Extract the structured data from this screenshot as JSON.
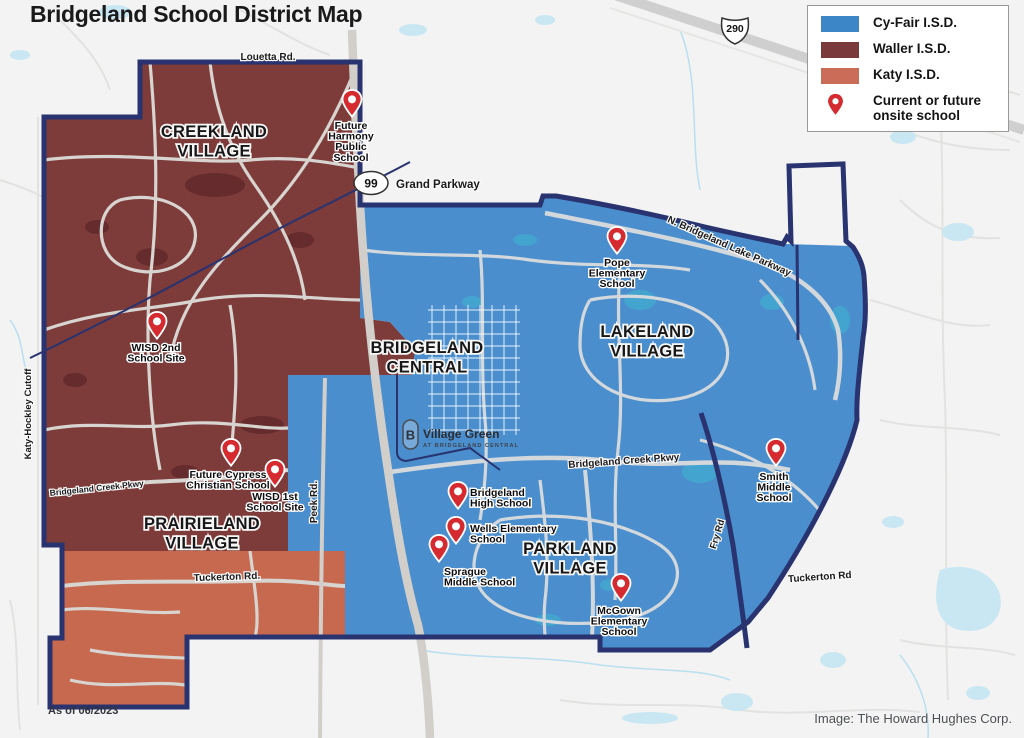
{
  "title": "Bridgeland School District Map",
  "legend": {
    "items": [
      {
        "label": "Cy-Fair I.S.D.",
        "color": "#3c86c8",
        "type": "swatch"
      },
      {
        "label": "Waller I.S.D.",
        "color": "#7a3a3b",
        "type": "swatch"
      },
      {
        "label": "Katy I.S.D.",
        "color": "#ca6c58",
        "type": "swatch"
      },
      {
        "label": "Current or future onsite school",
        "color": "#d52b30",
        "type": "pin"
      }
    ]
  },
  "footnotes": {
    "as_of": "As of 06/2023",
    "credit": "Image: The Howard Hughes Corp."
  },
  "colors": {
    "cyfair_fill": "#4a8ecd",
    "waller_fill": "#7d3b3a",
    "katy_fill": "#c7694f",
    "boundary_navy": "#28336f",
    "pin_red": "#d52b30",
    "water_outside": "#c9e7f3",
    "water_in_cyfair": "#43a4cf",
    "water_in_waller": "#662c2d"
  },
  "map": {
    "villages": [
      {
        "id": "creekland",
        "lines": [
          "CREEKLAND",
          "VILLAGE"
        ],
        "x": 214,
        "y": 137
      },
      {
        "id": "prairieland",
        "lines": [
          "PRAIRIELAND",
          "VILLAGE"
        ],
        "x": 202,
        "y": 529
      },
      {
        "id": "bridgeland-central",
        "lines": [
          "BRIDGELAND",
          "CENTRAL"
        ],
        "x": 427,
        "y": 353
      },
      {
        "id": "lakeland",
        "lines": [
          "LAKELAND",
          "VILLAGE"
        ],
        "x": 647,
        "y": 337
      },
      {
        "id": "parkland",
        "lines": [
          "PARKLAND",
          "VILLAGE"
        ],
        "x": 570,
        "y": 554
      }
    ],
    "schools": [
      {
        "id": "future-harmony-public-school",
        "lines": [
          "Future",
          "Harmony",
          "Public",
          "School"
        ],
        "pin": [
          352,
          118
        ],
        "lx": 351,
        "ly": 129,
        "anchor": "middle"
      },
      {
        "id": "wisd-2nd-school-site",
        "lines": [
          "WISD 2nd",
          "School Site"
        ],
        "pin": [
          157,
          340
        ],
        "lx": 156,
        "ly": 351,
        "anchor": "middle"
      },
      {
        "id": "future-cypress-christian-school",
        "lines": [
          "Future Cypress",
          "Christian School"
        ],
        "pin": [
          231,
          467
        ],
        "lx": 228,
        "ly": 478,
        "anchor": "middle"
      },
      {
        "id": "wisd-1st-school-site",
        "lines": [
          "WISD 1st",
          "School Site"
        ],
        "pin": [
          275,
          488
        ],
        "lx": 275,
        "ly": 500,
        "anchor": "middle"
      },
      {
        "id": "pope-elementary-school",
        "lines": [
          "Pope",
          "Elementary",
          "School"
        ],
        "pin": [
          617,
          255
        ],
        "lx": 617,
        "ly": 266,
        "anchor": "middle"
      },
      {
        "id": "bridgeland-high-school",
        "lines": [
          "Bridgeland",
          "High School"
        ],
        "pin": [
          458,
          510
        ],
        "lx": 470,
        "ly": 496,
        "anchor": "start"
      },
      {
        "id": "wells-elementary-school",
        "lines": [
          "Wells Elementary",
          "School"
        ],
        "pin": [
          456,
          545
        ],
        "lx": 470,
        "ly": 532,
        "anchor": "start"
      },
      {
        "id": "sprague-middle-school",
        "lines": [
          "Sprague",
          "Middle School"
        ],
        "pin": [
          439,
          563
        ],
        "lx": 444,
        "ly": 575,
        "anchor": "start"
      },
      {
        "id": "mcgown-elementary-school",
        "lines": [
          "McGown",
          "Elementary",
          "School"
        ],
        "pin": [
          621,
          602
        ],
        "lx": 619,
        "ly": 614,
        "anchor": "middle"
      },
      {
        "id": "smith-middle-school",
        "lines": [
          "Smith",
          "Middle",
          "School"
        ],
        "pin": [
          776,
          467
        ],
        "lx": 774,
        "ly": 480,
        "anchor": "middle"
      }
    ],
    "road_labels": [
      {
        "id": "louetta-rd",
        "label": "Louetta Rd.",
        "x": 268,
        "y": 60,
        "rotate": 0,
        "size": 10
      },
      {
        "id": "katy-hockley-cutoff",
        "label": "Katy-Hockley Cutoff",
        "x": 31,
        "y": 414,
        "rotate": -90,
        "size": 9.5
      },
      {
        "id": "bridgeland-creek-pkwy-west",
        "label": "Bridgeland Creek Pkwy",
        "x": 97,
        "y": 491,
        "rotate": -6,
        "size": 8.5
      },
      {
        "id": "peek-rd",
        "label": "Peek Rd.",
        "x": 317,
        "y": 502,
        "rotate": -90,
        "size": 10
      },
      {
        "id": "n-bridgeland-lake-parkway",
        "label": "N. Bridgeland Lake Parkway",
        "x": 728,
        "y": 249,
        "rotate": 24,
        "size": 10
      },
      {
        "id": "bridgeland-creek-pkwy-east",
        "label": "Bridgeland Creek Pkwy",
        "x": 624,
        "y": 464,
        "rotate": -4,
        "size": 10
      },
      {
        "id": "fry-rd",
        "label": "Fry Rd",
        "x": 720,
        "y": 535,
        "rotate": -73,
        "size": 9.5
      },
      {
        "id": "tuckerton-rd-west",
        "label": "Tuckerton Rd.",
        "x": 227,
        "y": 580,
        "rotate": -2,
        "size": 10
      },
      {
        "id": "tuckerton-rd-east",
        "label": "Tuckerton Rd",
        "x": 820,
        "y": 580,
        "rotate": -4,
        "size": 10
      }
    ],
    "shields": [
      {
        "id": "hwy-99",
        "type": "oval",
        "number": "99",
        "x": 371,
        "y": 183,
        "label": "Grand Parkway",
        "label_x": 396,
        "label_y": 188
      },
      {
        "id": "us-290",
        "type": "us-shield",
        "number": "290",
        "x": 735,
        "y": 28,
        "label": "",
        "label_x": 0,
        "label_y": 0
      }
    ],
    "village_green": {
      "mark": "B",
      "line1": "Village Green",
      "line2": "AT BRIDGELAND CENTRAL",
      "x": 403,
      "y": 420
    }
  }
}
